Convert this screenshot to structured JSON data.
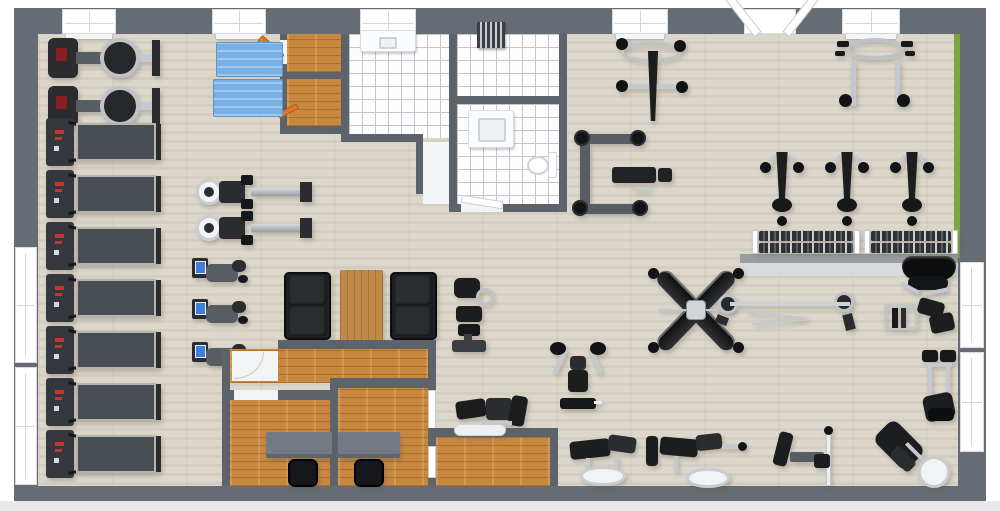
{
  "floorplan": {
    "title": "Gym 3D Floor Plan",
    "style": "3D top-down architectural rendering, no text labels",
    "canvas": {
      "width": 1000,
      "height": 511
    },
    "palette": {
      "wall": "#666c74",
      "inner_wall": "#5d636b",
      "main_floor_wood": "#dcd6cb",
      "office_floor_wood": "#c8873e",
      "tile": "#fdfdfd",
      "tile_grout": "#c3c7cd",
      "mat_blue": "#79b0e4",
      "accent_green": "#7ca43f",
      "equipment_black": "#17181a",
      "chrome": "#c5c8cc",
      "machine_gray": "#585d64",
      "desk_gray": "#747a82",
      "door_orange": "#df7a22",
      "sidewalk": "#e8e8eb"
    },
    "zones": [
      {
        "name": "Cardio zone",
        "location": "left"
      },
      {
        "name": "Stretching mats area",
        "location": "top left"
      },
      {
        "name": "Locker / shower / bathroom block",
        "location": "top center"
      },
      {
        "name": "Lounge seating",
        "location": "center"
      },
      {
        "name": "Office suite",
        "location": "bottom center"
      },
      {
        "name": "Free weights and machines",
        "location": "right"
      }
    ],
    "rooms": [
      {
        "id": "main-floor",
        "label": "Open gym area",
        "floor": "light wood"
      },
      {
        "id": "closet-1",
        "label": "Storage closet",
        "floor": "orange wood"
      },
      {
        "id": "closet-2",
        "label": "Storage closet",
        "floor": "orange wood"
      },
      {
        "id": "shower-room-left",
        "label": "Shower room with vanity",
        "floor": "white tile"
      },
      {
        "id": "shower-room-right",
        "label": "Changing room with towel shelf",
        "floor": "white tile"
      },
      {
        "id": "bathroom",
        "label": "Bathroom with sink and toilet",
        "floor": "white tile"
      },
      {
        "id": "corridor",
        "label": "Corridor",
        "floor": "white"
      },
      {
        "id": "reception",
        "label": "Reception room",
        "floor": "orange wood"
      },
      {
        "id": "office-1",
        "label": "Office with desk",
        "floor": "orange wood"
      },
      {
        "id": "office-2",
        "label": "Office with desk",
        "floor": "orange wood"
      },
      {
        "id": "back-room",
        "label": "Back room",
        "floor": "orange wood"
      }
    ],
    "architecture": {
      "windows_top_wall": 5,
      "windows_left_wall": 2,
      "windows_right_wall": 2,
      "entrance": "open double doors, top right",
      "accent": "green strip on upper right interior wall"
    },
    "labels": {
      "treadmill": "Treadmill",
      "rower_flywheel": "Rowing machine (flywheel)",
      "rower_rail": "Rowing machine (rail)",
      "bike": "Exercise bike",
      "mat": "Blue exercise mat",
      "closet_door": "Open closet door",
      "lat_pulldown": "Lat pulldown machine",
      "pullup_station": "Pull-up / dip station",
      "bench_press": "Bench press station",
      "cable_column": "Cable column machine",
      "dumbbell_rack": "Dumbbell rack",
      "bench": "Adjustable bench",
      "crossover": "Cable crossover machine",
      "barbell": "Barbell on stands",
      "plate_machine": "Plate-loaded press machine",
      "hack_squat": "Hack squat machine",
      "leg_press": "Leg press machine",
      "preacher_curl": "Preacher curl machine",
      "leg_extension": "Leg extension machine",
      "pec_fly": "Pec fly machine",
      "leg_curl": "Leg curl machine",
      "calf_raise": "Calf raise machine",
      "sofa": "Sofa",
      "coffee_table": "Coffee table",
      "desk": "Office desk",
      "chair": "Office chair",
      "vanity": "Sink vanity",
      "toilet": "Toilet",
      "towel_shelf": "Towel shelf",
      "window": "Window",
      "entrance": "Entrance double doors",
      "counter": "Dumbbell platform ledge"
    },
    "equipment_inventory": [
      {
        "item": "Treadmill",
        "count": 7
      },
      {
        "item": "Rowing machine (flywheel)",
        "count": 2
      },
      {
        "item": "Rowing machine (rail)",
        "count": 2
      },
      {
        "item": "Exercise bike",
        "count": 3
      },
      {
        "item": "Blue exercise mat",
        "count": 2
      },
      {
        "item": "Lat pulldown machine",
        "count": 1
      },
      {
        "item": "Pull-up / dip station",
        "count": 1
      },
      {
        "item": "Bench press station",
        "count": 1
      },
      {
        "item": "Cable column machine",
        "count": 3
      },
      {
        "item": "Dumbbell rack",
        "count": 2
      },
      {
        "item": "Adjustable bench",
        "count": 1
      },
      {
        "item": "Cable crossover machine",
        "count": 1
      },
      {
        "item": "Barbell on stands",
        "count": 1
      },
      {
        "item": "Plate-loaded press machine",
        "count": 1
      },
      {
        "item": "Hack squat machine",
        "count": 1
      },
      {
        "item": "Leg press machine",
        "count": 1
      },
      {
        "item": "Preacher curl machine",
        "count": 1
      },
      {
        "item": "Leg extension machine",
        "count": 1
      },
      {
        "item": "Pec fly machine",
        "count": 1
      },
      {
        "item": "Leg curl machine",
        "count": 2
      },
      {
        "item": "Calf raise machine",
        "count": 1
      },
      {
        "item": "Sofa",
        "count": 2
      },
      {
        "item": "Coffee table",
        "count": 1
      },
      {
        "item": "Office desk",
        "count": 2
      },
      {
        "item": "Office chair",
        "count": 2
      },
      {
        "item": "Sink vanity",
        "count": 2
      },
      {
        "item": "Toilet",
        "count": 1
      },
      {
        "item": "Towel shelf",
        "count": 1
      }
    ]
  }
}
